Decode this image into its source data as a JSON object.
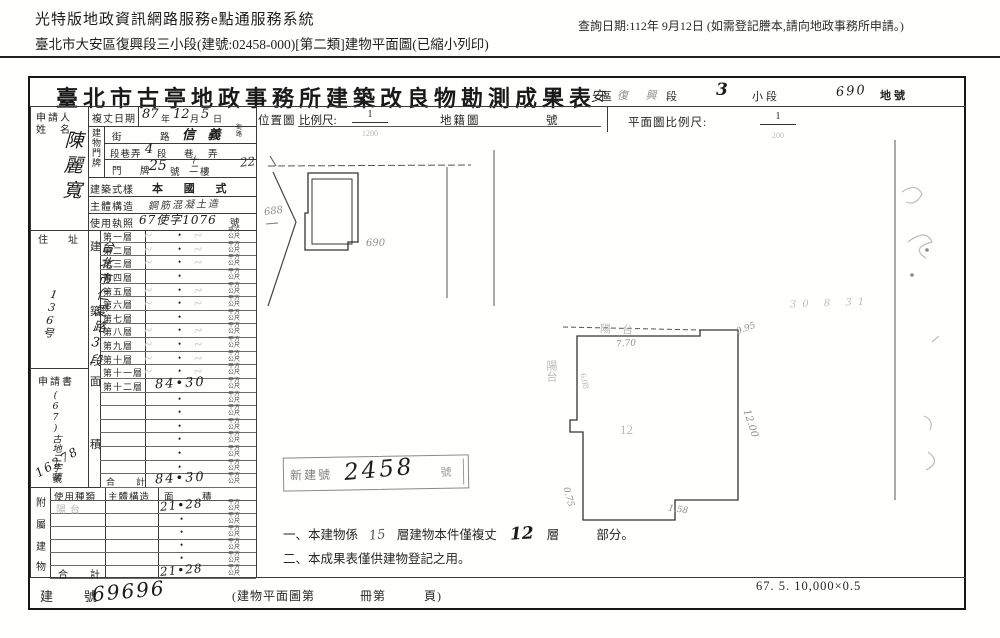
{
  "header": {
    "system_title": "光特版地政資訊網路服務e點通服務系統",
    "query_date": "查詢日期:112年 9月12日 (如需登記謄本,請向地政事務所申請。)",
    "subtitle": "臺北市大安區復興段三小段(建號:02458-000)[第二類]建物平面圖(已縮小列印)"
  },
  "form": {
    "title": "臺北市古亭地政事務所建築改良物勘測成果表",
    "land": {
      "district_value": "大 安",
      "district_label": "區",
      "section_value": "復 興",
      "section_label": "段",
      "subsection_value": "3",
      "subsection_label": "小段",
      "lot_value": "690",
      "lot_label": "地號"
    },
    "applicant": {
      "label_top": "申請人",
      "label_bottom": "姓　名",
      "name": "陳麗寬"
    },
    "survey_date": {
      "label": "複丈日期",
      "year": "87",
      "year_unit": "年",
      "month": "12",
      "month_unit": "月",
      "day": "5",
      "day_unit": "日"
    },
    "plate": {
      "label": "建物門牌",
      "street_label_a": "街",
      "street_label_b": "路",
      "street_value": "信 義",
      "street_unit_top": "街",
      "street_unit_bottom": "路",
      "section_label": "段巷弄",
      "section_value": "4",
      "section_unit": "段",
      "lane_unit": "巷",
      "alley_unit": "弄",
      "door_label_a": "門",
      "door_label_b": "牌",
      "door_value": "25",
      "door_unit": "號",
      "floor_value": "十二",
      "floor_unit": "樓",
      "margin_note": "22"
    },
    "style": {
      "label": "建築式樣",
      "value": "本 國 式"
    },
    "structure": {
      "label": "主體構造",
      "value": "鋼筋混凝土造"
    },
    "license": {
      "label": "使用執照",
      "value": "67使字1076",
      "unit": "號"
    },
    "residence": {
      "label": "住　址",
      "value": "台北市仁愛路3段",
      "house_no": "136号"
    },
    "application": {
      "label": "申請書",
      "value": "(67)古地二字第",
      "number": "16278",
      "unit": "號"
    },
    "area": {
      "spine": [
        "建",
        "築",
        "面",
        "積"
      ],
      "unit_top": "平方",
      "unit_bottom": "公尺",
      "rows": [
        {
          "label": "第一層",
          "value": "",
          "faint": true
        },
        {
          "label": "第二層",
          "value": "",
          "faint": true
        },
        {
          "label": "第三層",
          "value": "",
          "faint": true
        },
        {
          "label": "第四層",
          "value": "",
          "faint": false
        },
        {
          "label": "第五層",
          "value": "",
          "faint": true
        },
        {
          "label": "第六層",
          "value": "",
          "faint": true
        },
        {
          "label": "第七層",
          "value": "",
          "faint": false
        },
        {
          "label": "第八層",
          "value": "",
          "faint": true
        },
        {
          "label": "第九層",
          "value": "",
          "faint": true
        },
        {
          "label": "第十層",
          "value": "",
          "faint": true
        },
        {
          "label": "第十一層",
          "value": "",
          "faint": true
        },
        {
          "label": "第十二層",
          "value": "84•30",
          "faint": false
        },
        {
          "label": "",
          "value": "",
          "faint": false
        },
        {
          "label": "",
          "value": "",
          "faint": false
        },
        {
          "label": "",
          "value": "",
          "faint": false
        },
        {
          "label": "",
          "value": "",
          "faint": false
        },
        {
          "label": "",
          "value": "",
          "faint": false
        },
        {
          "label": "",
          "value": "",
          "faint": false
        },
        {
          "label": "合　計",
          "value": "84•30",
          "faint": false,
          "total": true
        }
      ]
    },
    "annex": {
      "spine": [
        "附",
        "屬",
        "建",
        "物"
      ],
      "headers": [
        "使用種類",
        "主體構造",
        "面",
        "積"
      ],
      "unit_top": "平方",
      "unit_bottom": "公尺",
      "rows": [
        {
          "use": "陽台",
          "area": "21•28"
        },
        {
          "use": "",
          "area": ""
        },
        {
          "use": "",
          "area": ""
        },
        {
          "use": "",
          "area": ""
        },
        {
          "use": "",
          "area": ""
        },
        {
          "label": "合　計",
          "use": "",
          "area": "21•28",
          "total": true
        }
      ]
    },
    "building_no": {
      "label": "建　號",
      "value": "69696",
      "note1": "(建物平面圖第",
      "note2": "冊第",
      "note3": "頁)"
    },
    "location_map": {
      "label": "位置圖",
      "scale_label": "比例尺:",
      "scale_num": "1",
      "scale_den": "1200",
      "cadastral_label": "地籍圖",
      "no_label": "號",
      "lot_a": "688",
      "lot_b": "690"
    },
    "floor_plan": {
      "scale_label": "平面圖比例尺:",
      "scale_num": "1",
      "scale_den": "200",
      "balcony_top": "陽　台",
      "balcony_left": "陽台",
      "dim_top": "7.70",
      "dim_top_right": "0.95",
      "dim_right": "12.00",
      "dim_left": "6.08",
      "dim_bottom_left": "0.75",
      "dim_bottom_right": "1.58",
      "center_mark": "12"
    },
    "stamp": {
      "prefix": "新建號",
      "number": "2458",
      "suffix": "號"
    },
    "notes": {
      "n1_no": "一、",
      "n1a": "本建物係",
      "n1_hw1": "15",
      "n1b": "層建物本件僅複丈",
      "n1_hw2": "12",
      "n1c": "層",
      "n1d": "部分。",
      "n2_no": "二、",
      "n2": "本成果表僅供建物登記之用。"
    },
    "footer_scale": "67. 5. 10,000×0.5",
    "margin_scribble": "30 8 31"
  },
  "misc": {
    "dot": "•",
    "scribble": "~"
  }
}
